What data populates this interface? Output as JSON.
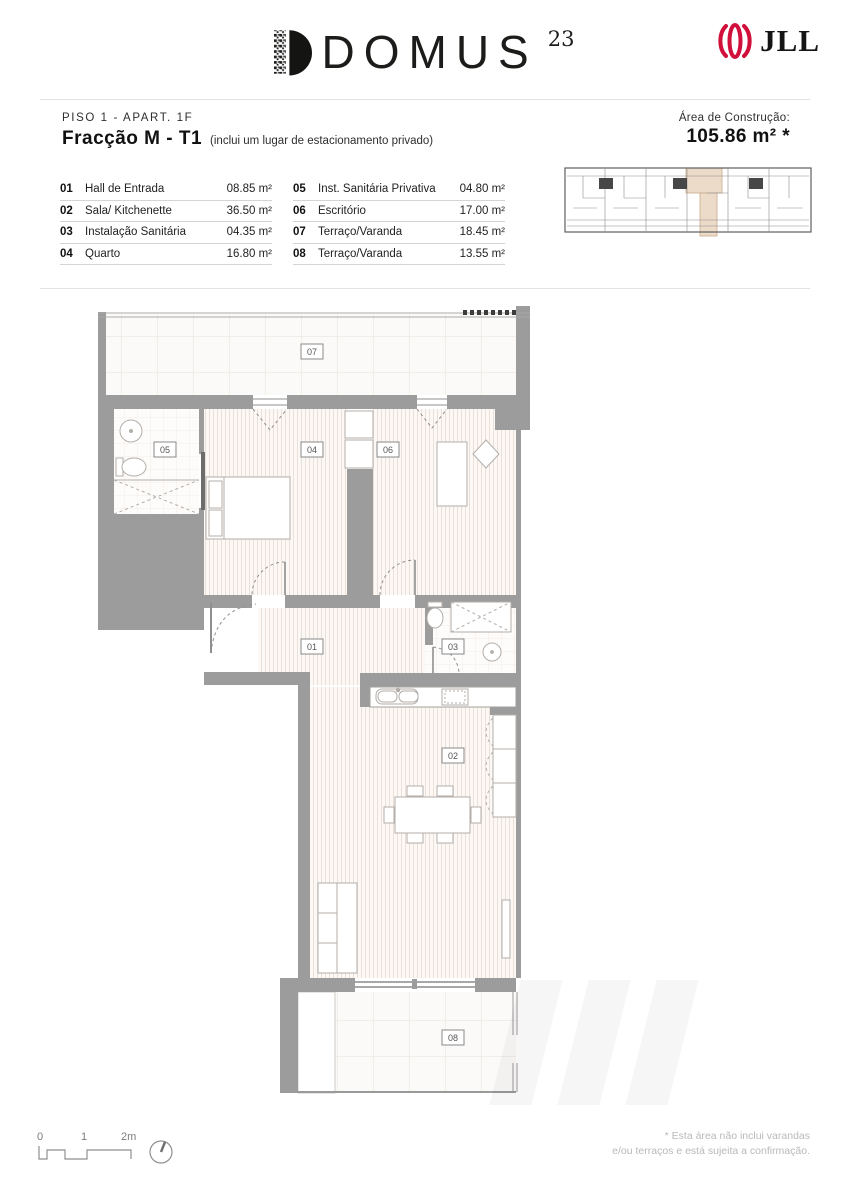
{
  "brand": {
    "name": "DOMUS",
    "superscript": "23",
    "partner": "JLL"
  },
  "title": {
    "floor_line": "PISO 1 - APART. 1F",
    "fraction": "Fracção M - T1",
    "fraction_note": "(inclui um lugar de estacionamento privado)",
    "area_label": "Área de Construção:",
    "area_value": "105.86 m² *"
  },
  "rooms": [
    {
      "num": "01",
      "name": "Hall de Entrada",
      "area": "08.85 m²"
    },
    {
      "num": "02",
      "name": "Sala/ Kitchenette",
      "area": "36.50 m²"
    },
    {
      "num": "03",
      "name": "Instalação Sanitária",
      "area": "04.35 m²"
    },
    {
      "num": "04",
      "name": "Quarto",
      "area": "16.80 m²"
    },
    {
      "num": "05",
      "name": "Inst. Sanitária Privativa",
      "area": "04.80 m²"
    },
    {
      "num": "06",
      "name": "Escritório",
      "area": "17.00 m²"
    },
    {
      "num": "07",
      "name": "Terraço/Varanda",
      "area": "18.45 m²"
    },
    {
      "num": "08",
      "name": "Terraço/Varanda",
      "area": "13.55 m²"
    }
  ],
  "scalebar": {
    "t0": "0",
    "t1": "1",
    "t2": "2m"
  },
  "footer": {
    "line1": "* Esta área não inclui varandas",
    "line2": "e/ou terraços e está sujeita a confirmação."
  },
  "colors": {
    "wall": "#9c9c9c",
    "highlight": "#ecdbc9",
    "jll_red": "#d0103a"
  }
}
